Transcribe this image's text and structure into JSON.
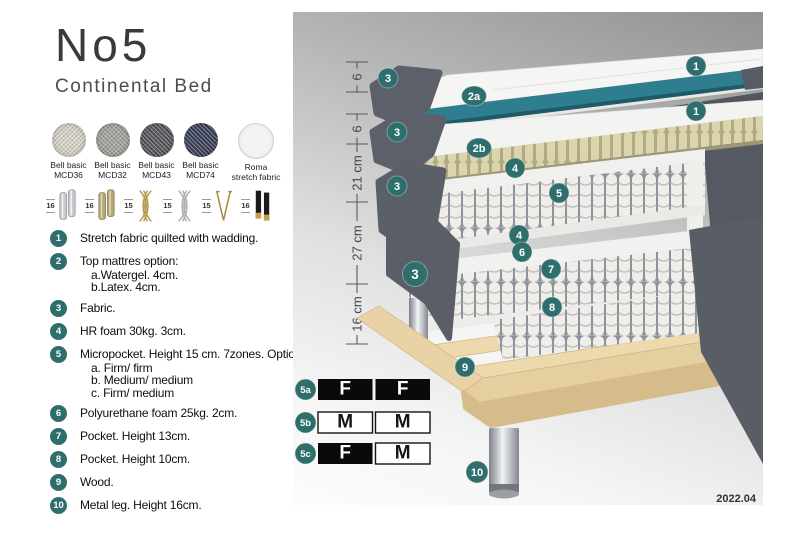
{
  "brand": {
    "title": "No5",
    "subtitle": "Continental Bed"
  },
  "fabrics": [
    {
      "label": "Bell basic",
      "code": "MCD36",
      "color": "#D9D5CA",
      "style_var": "--c:#D9D5CA"
    },
    {
      "label": "Bell basic",
      "code": "MCD32",
      "color": "#A3A19C",
      "style_var": "--c:#A3A19C"
    },
    {
      "label": "Bell basic",
      "code": "MCD43",
      "color": "#53555A",
      "style_var": "--c:#53555A"
    },
    {
      "label": "Bell basic",
      "code": "MCD74",
      "color": "#3A3F58",
      "style_var": "--c:#3A3F58"
    },
    {
      "label": "Roma",
      "code": "stretch fabric",
      "color": "#F3F3F2",
      "style_var": "--c:#F3F3F2"
    }
  ],
  "legs": [
    {
      "size": "16",
      "type": "cylinder-chrome"
    },
    {
      "size": "16",
      "type": "cylinder-brass"
    },
    {
      "size": "15",
      "type": "twist-gold"
    },
    {
      "size": "15",
      "type": "twist-chrome"
    },
    {
      "size": "15",
      "type": "hairpin-gold"
    },
    {
      "size": "16",
      "type": "block-black-gold"
    }
  ],
  "features": [
    {
      "num": "1",
      "text": "Stretch fabric quilted with wadding."
    },
    {
      "num": "2",
      "text": "Top mattres option:",
      "sub": [
        "a.Watergel. 4cm.",
        "b.Latex. 4cm."
      ]
    },
    {
      "num": "3",
      "text": "Fabric."
    },
    {
      "num": "4",
      "text": "HR foam 30kg. 3cm."
    },
    {
      "num": "5",
      "text": "Micropocket. Height 15 cm. 7zones. Option:",
      "sub": [
        "a. Firm/ firm",
        "b. Medium/ medium",
        "c. Firm/ medium"
      ]
    },
    {
      "num": "6",
      "text": "Polyurethane foam 25kg. 2cm."
    },
    {
      "num": "7",
      "text": "Pocket. Height 13cm."
    },
    {
      "num": "8",
      "text": "Pocket. Height 10cm."
    },
    {
      "num": "9",
      "text": "Wood."
    },
    {
      "num": "10",
      "text": "Metal leg. Height 16cm."
    }
  ],
  "diagram": {
    "measurements": [
      {
        "label": "6"
      },
      {
        "label": "6"
      },
      {
        "label": "21 cm"
      },
      {
        "label": "27 cm"
      },
      {
        "label": "16 cm"
      }
    ],
    "badges": [
      {
        "label": "3"
      },
      {
        "label": "2a"
      },
      {
        "label": "1"
      },
      {
        "label": "3"
      },
      {
        "label": "2b"
      },
      {
        "label": "1"
      },
      {
        "label": "4"
      },
      {
        "label": "5"
      },
      {
        "label": "4"
      },
      {
        "label": "3"
      },
      {
        "label": "6"
      },
      {
        "label": "7"
      },
      {
        "label": "3"
      },
      {
        "label": "8"
      },
      {
        "label": "9"
      },
      {
        "label": "10"
      }
    ],
    "firmness": {
      "rows": [
        {
          "id": "5a",
          "cells": [
            {
              "letter": "F",
              "cell_cls": "fcell dark",
              "text_cls": "flet dark"
            },
            {
              "letter": "F",
              "cell_cls": "fcell dark",
              "text_cls": "flet dark"
            }
          ]
        },
        {
          "id": "5b",
          "cells": [
            {
              "letter": "M",
              "cell_cls": "fcell light",
              "text_cls": "flet light"
            },
            {
              "letter": "M",
              "cell_cls": "fcell light",
              "text_cls": "flet light"
            }
          ]
        },
        {
          "id": "5c",
          "cells": [
            {
              "letter": "F",
              "cell_cls": "fcell dark",
              "text_cls": "flet dark"
            },
            {
              "letter": "M",
              "cell_cls": "fcell light",
              "text_cls": "flet light"
            }
          ]
        }
      ]
    },
    "version": "2022.04"
  },
  "colors": {
    "accent": "#2E6F6E",
    "teal_core": "#2E7E8F",
    "fabric_gray": "#5C6069",
    "latex_beige": "#DBD5AD",
    "wood": "#E7D0A2",
    "panel_gray_top": "#929292"
  }
}
